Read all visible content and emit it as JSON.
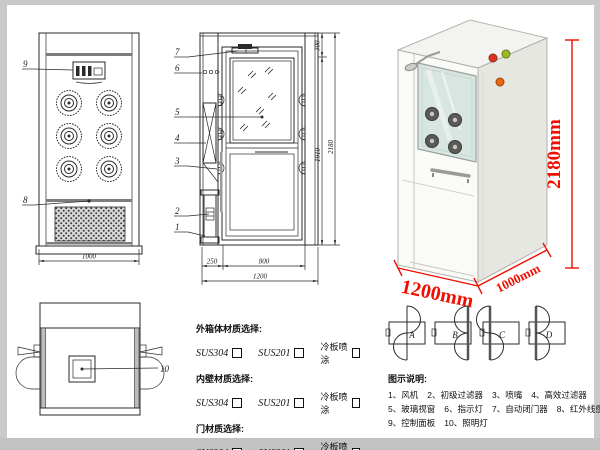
{
  "front_view": {
    "callout_9": "9",
    "callout_8": "8",
    "dim_width": "1000"
  },
  "section_view": {
    "callout_7": "7",
    "callout_6": "6",
    "callout_5": "5",
    "callout_4": "4",
    "callout_3": "3",
    "callout_2": "2",
    "callout_1": "1",
    "dim_top": "300",
    "dim_inner_height": "1910",
    "dim_total_height": "2180",
    "dim_left_section": "250",
    "dim_door": "800",
    "dim_total_width": "1200"
  },
  "top_view": {
    "callout_10": "10"
  },
  "render_3d": {
    "height_label": "2180mm",
    "width_label": "1200mm",
    "depth_label": "1000mm",
    "accent_color": "#ee0f00"
  },
  "door_options": {
    "a": "A",
    "b": "B",
    "c": "C",
    "d": "D"
  },
  "materials": {
    "sections": [
      {
        "title": "外箱体材质选择:",
        "options": [
          "SUS304",
          "SUS201",
          "冷板喷涂"
        ]
      },
      {
        "title": "内壁材质选择:",
        "options": [
          "SUS304",
          "SUS201",
          "冷板喷涂"
        ]
      },
      {
        "title": "门材质选择:",
        "options": [
          "SUS304",
          "SUS201",
          "冷板喷涂"
        ]
      }
    ]
  },
  "legend": {
    "title": "图示说明:",
    "rows": [
      [
        "1、风机",
        "2、初级过滤器",
        "3、喷嘴",
        "4、高效过滤器"
      ],
      [
        "5、玻璃视窗",
        "6、指示灯",
        "7、自动闭门器",
        "8、红外线感应器"
      ],
      [
        "9、控制面板",
        "10、照明灯"
      ]
    ]
  }
}
